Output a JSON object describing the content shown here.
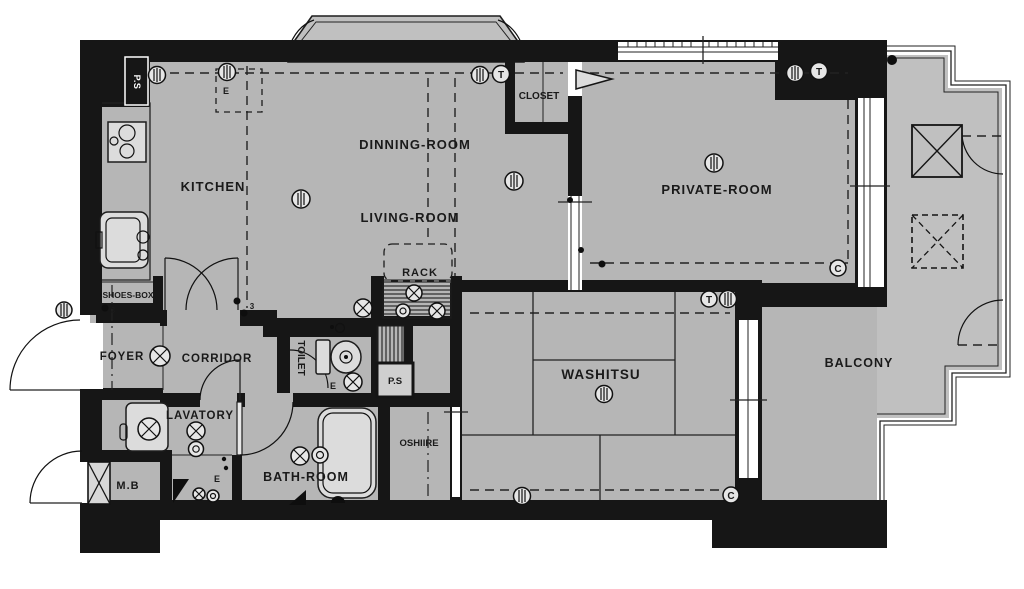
{
  "plan": {
    "rooms": {
      "kitchen": "KITCHEN",
      "dinning_room": "DINNING-ROOM",
      "living_room": "LIVING-ROOM",
      "closet": "CLOSET",
      "private_room": "PRIVATE-ROOM",
      "rack": "RACK",
      "shoes_box": "SHOES-BOX",
      "foyer": "FOYER",
      "corridor": "CORRIDOR",
      "toilet": "TOILET",
      "pipe_space_top": "P.S",
      "pipe_space_mid": "P.S",
      "lavatory": "LAVATORY",
      "meter_box": "M.B",
      "bath_room": "BATH-ROOM",
      "oshiire": "OSHIIRE",
      "washitsu": "WASHITSU",
      "balcony": "BALCONY"
    },
    "annotations": {
      "e_mark": "E",
      "hinge_mark": "3",
      "tv_outlet": "T",
      "cable_outlet": "C"
    },
    "colors": {
      "wall": "#161616",
      "floor": "#b6b6b6",
      "balcony_floor": "#c0c0c0",
      "line": "#222222",
      "text": "#1a1a1a"
    }
  }
}
